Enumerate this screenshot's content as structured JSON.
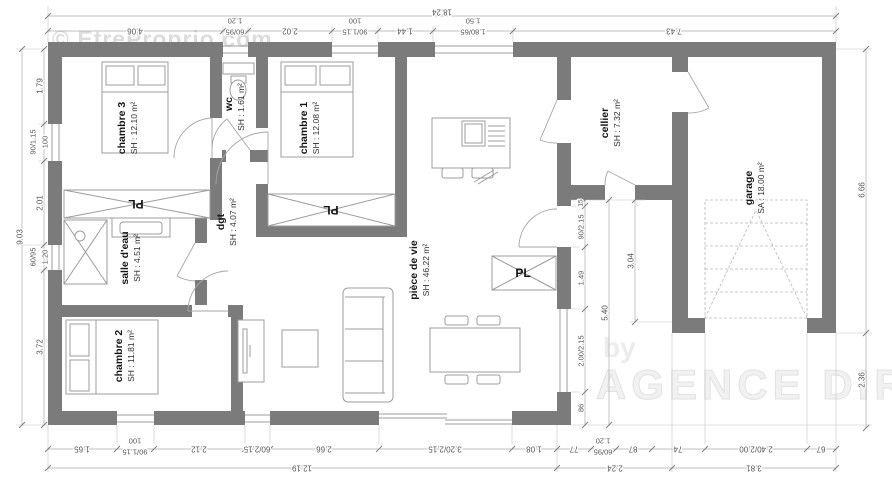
{
  "watermarks": {
    "site": "© EtreProprio.com",
    "by": "by",
    "agency": "AGENCE DIRECTE"
  },
  "rooms": {
    "chambre3": {
      "name": "chambre 3",
      "area": "SH : 12.10 m²"
    },
    "wc": {
      "name": "wc",
      "area": "SH : 1.61 m²"
    },
    "chambre1": {
      "name": "chambre 1",
      "area": "SH : 12.08 m²"
    },
    "dgt": {
      "name": "dgt",
      "area": "SH : 4.07 m²"
    },
    "salle_deau": {
      "name": "salle d'eau",
      "area": "SH : 4.51 m²"
    },
    "chambre2": {
      "name": "chambre 2",
      "area": "SH : 11.81 m²"
    },
    "piece_de_vie": {
      "name": "pièce de vie",
      "area": "SH : 46.22 m²"
    },
    "cellier": {
      "name": "cellier",
      "area": "SH : 7.32 m²"
    },
    "garage": {
      "name": "garage",
      "area": "SA : 18.00 m²"
    },
    "closet_label": "PL"
  },
  "dimensions": {
    "top_total": "18.24",
    "top": [
      "4.06",
      "1.20",
      "60/95",
      "2.02",
      "100",
      "90/1.15",
      "1.44",
      "1.50",
      "1.80/65",
      "7.43"
    ],
    "left_total": "9.03",
    "left": [
      "1.79",
      "90/1.15",
      "100",
      "2.01",
      "60/95",
      "1.20",
      "3.72"
    ],
    "right": [
      "6.66",
      "2.36"
    ],
    "bottom": [
      "1.65",
      "100",
      "90/1.15",
      "2.12",
      "60/2.15",
      "2.66",
      "3.20/2.15",
      "1.08",
      "77",
      "1.20",
      "60/95",
      "87",
      "74",
      "2.40/2.00",
      "67"
    ],
    "bottom_totals": [
      "12.19",
      "2.24",
      "3.81"
    ],
    "interior": [
      "15",
      "90/2.15",
      "1.49",
      "2.00/2.15",
      "86",
      "5.40",
      "3.04"
    ]
  }
}
